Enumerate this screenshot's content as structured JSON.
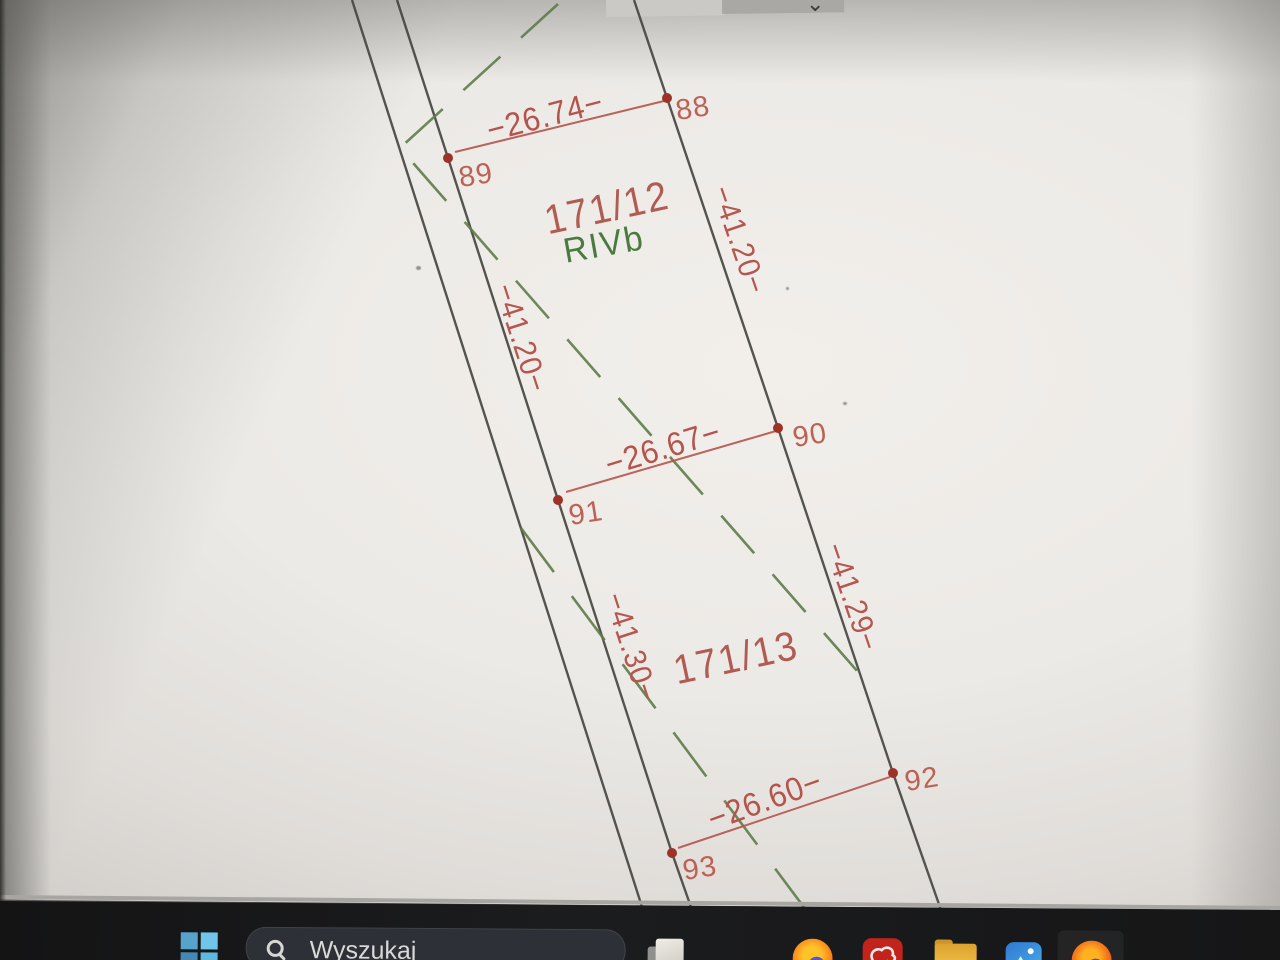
{
  "viewer_toolbar": {
    "chevron_icon": "⌄"
  },
  "map": {
    "parcels": [
      {
        "number": "171/12",
        "soil_class": "RIVb"
      },
      {
        "number": "171/13"
      }
    ],
    "boundary_points": [
      {
        "id": "88"
      },
      {
        "id": "89"
      },
      {
        "id": "90"
      },
      {
        "id": "91"
      },
      {
        "id": "92"
      },
      {
        "id": "93"
      }
    ],
    "width_dimensions": [
      {
        "value": "−26.74−"
      },
      {
        "value": "−26.67−"
      },
      {
        "value": "−26.60−"
      }
    ],
    "length_dimensions": [
      {
        "value": "−41.20−"
      },
      {
        "value": "−41.20−"
      },
      {
        "value": "−41.29−"
      },
      {
        "value": "−41.30−"
      }
    ],
    "colors": {
      "dimension_red": "#b4544d",
      "point_dot_red": "#9e3226",
      "soil_class_green": "#4a7a40",
      "landuse_dash_green": "#5e7c48",
      "boundary_line_black": "#44443f"
    }
  },
  "taskbar": {
    "search": {
      "placeholder": "Wyszukaj"
    },
    "icons": [
      {
        "name": "file-explorer"
      },
      {
        "name": "firefox"
      },
      {
        "name": "red-map-app"
      },
      {
        "name": "folder"
      },
      {
        "name": "photos"
      },
      {
        "name": "firefox-2"
      }
    ]
  }
}
